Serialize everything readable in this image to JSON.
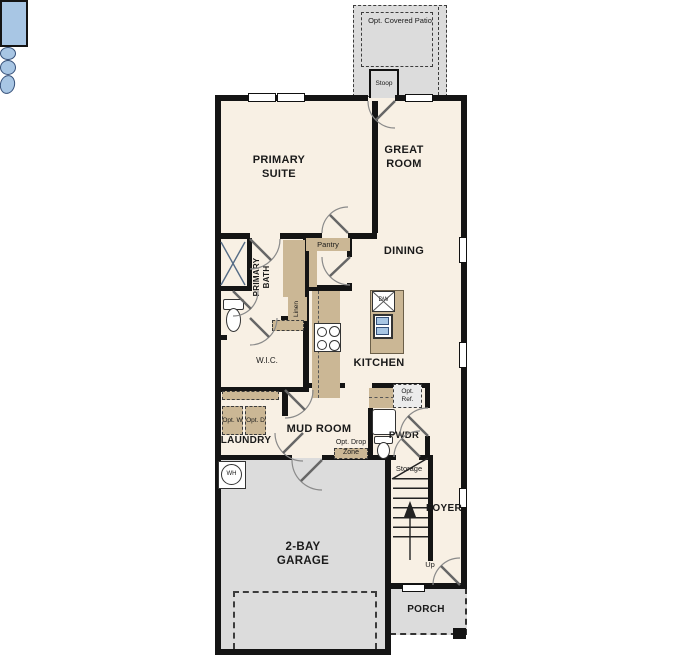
{
  "plan": {
    "labels": {
      "patio": "Opt. Covered Patio",
      "stoop": "Stoop",
      "primary_suite": "PRIMARY SUITE",
      "great_room": "GREAT ROOM",
      "dining": "DINING",
      "kitchen": "KITCHEN",
      "primary_bath": "PRIMARY BATH",
      "pantry": "Pantry",
      "linen": "Linen",
      "wic": "W.I.C.",
      "laundry": "LAUNDRY",
      "mud_room": "MUD ROOM",
      "drop_zone": "Opt. Drop Zone",
      "pwdr": "PWDR",
      "opt_ref": "Opt. Ref.",
      "opt_w": "Opt. W",
      "opt_d": "Opt. D",
      "storage": "Storage",
      "foyer": "FOYER",
      "up": "Up",
      "wh": "WH",
      "dw": "DW",
      "garage": "2-BAY GARAGE",
      "porch": "PORCH"
    },
    "colors": {
      "floor": "#f8f0e4",
      "outdoor_concrete": "#dcdcdc",
      "walls": "#141414",
      "cabinetry": "#cbb795",
      "plumbing_blue": "#a8c6e4"
    }
  }
}
